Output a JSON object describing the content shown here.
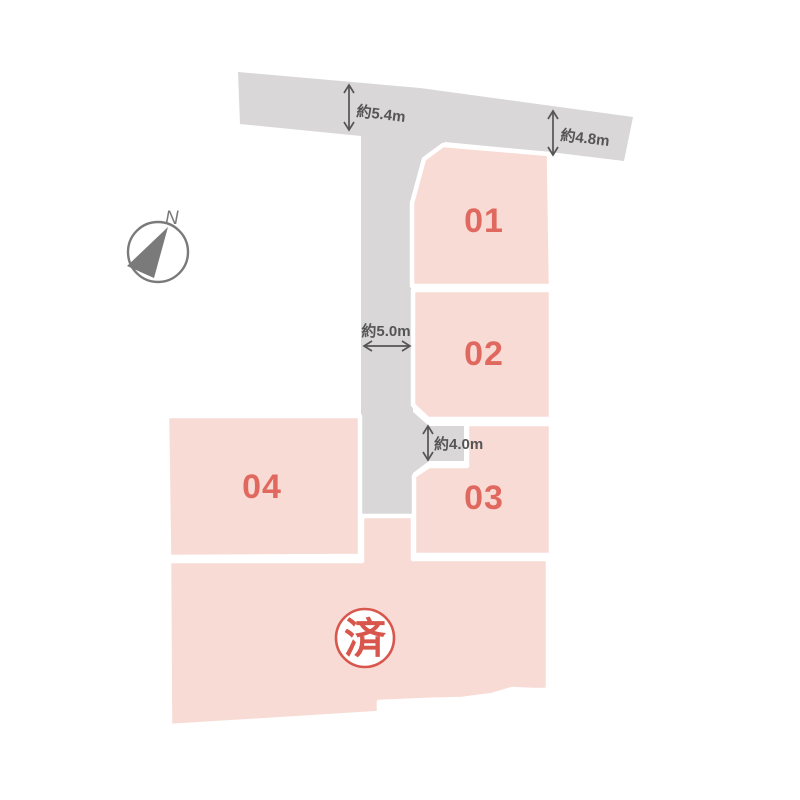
{
  "plan": {
    "name": "土地区画図",
    "sold_status_label": "済"
  },
  "colors": {
    "background": "#ffffff",
    "lot_fill": "#f9dbd5",
    "road_fill": "#d9d7d7",
    "lot_number": "#e0695f",
    "sold_accent": "#d8564c",
    "sold_badge_fill": "#ffffff",
    "dimension": "#555555",
    "compass": "#7a7a7a"
  },
  "compass": {
    "north_label": "N"
  },
  "lots": [
    {
      "id": "01",
      "label": "01",
      "status": "available"
    },
    {
      "id": "02",
      "label": "02",
      "status": "available"
    },
    {
      "id": "03",
      "label": "03",
      "status": "available"
    },
    {
      "id": "04",
      "label": "04",
      "status": "available"
    },
    {
      "id": "sold",
      "label": "済",
      "status": "sold"
    }
  ],
  "dimensions": [
    {
      "id": "road-top-left-width",
      "label": "約5.4m"
    },
    {
      "id": "road-top-right-width",
      "label": "約4.8m"
    },
    {
      "id": "road-vertical-width",
      "label": "約5.0m"
    },
    {
      "id": "access-width",
      "label": "約4.0m"
    }
  ]
}
